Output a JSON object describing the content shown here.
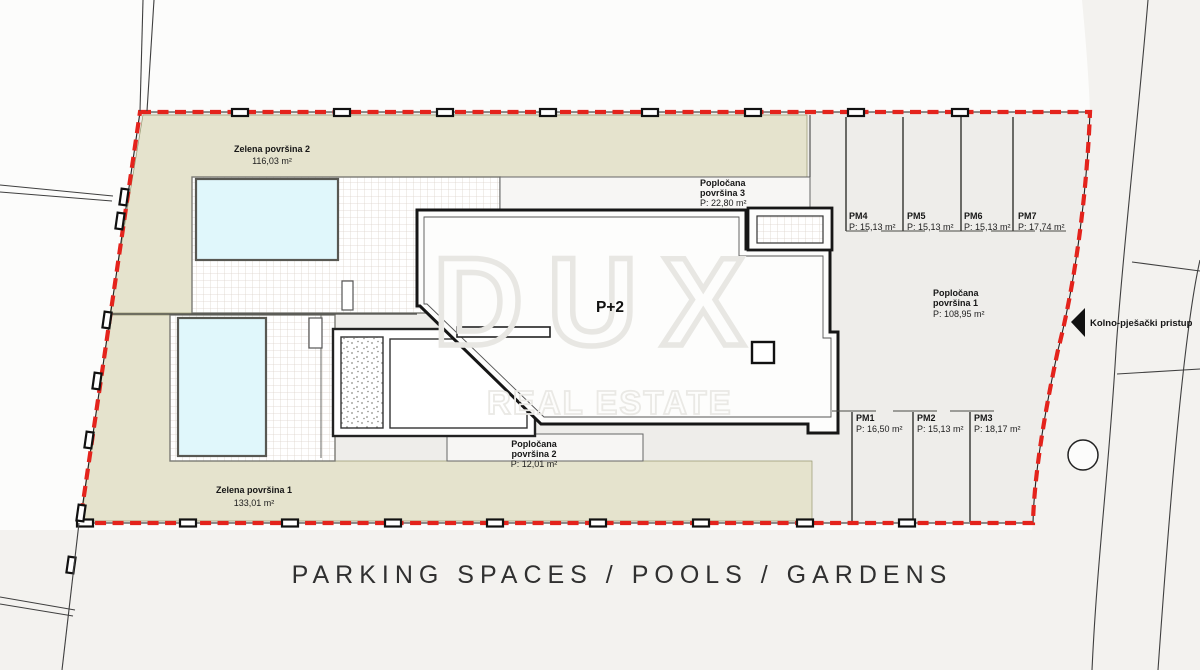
{
  "plan_title": "PARKING SPACES / POOLS / GARDENS",
  "watermark": {
    "brand": "DUX",
    "tagline": "REAL ESTATE"
  },
  "building": {
    "floors_label": "P+2"
  },
  "access_road": {
    "label": "Kolno-pješački pristup"
  },
  "green_areas": [
    {
      "name": "Zelena površina 2",
      "area": "116,03 m²"
    },
    {
      "name": "Zelena površina 1",
      "area": "133,01 m²"
    }
  ],
  "paved_areas": [
    {
      "name_line1": "Popločana",
      "name_line2": "površina 1",
      "area": "P: 108,95 m²"
    },
    {
      "name_line1": "Popločana",
      "name_line2": "površina 2",
      "area": "P: 12,01 m²"
    },
    {
      "name_line1": "Popločana",
      "name_line2": "površina 3",
      "area": "P: 22,80 m²"
    }
  ],
  "parking_spaces": [
    {
      "id": "PM1",
      "area": "P: 16,50 m²"
    },
    {
      "id": "PM2",
      "area": "P: 15,13 m²"
    },
    {
      "id": "PM3",
      "area": "P: 18,17 m²"
    },
    {
      "id": "PM4",
      "area": "P: 15,13 m²"
    },
    {
      "id": "PM5",
      "area": "P: 15,13 m²"
    },
    {
      "id": "PM6",
      "area": "P: 15,13 m²"
    },
    {
      "id": "PM7",
      "area": "P: 17,74 m²"
    }
  ],
  "colors": {
    "boundary_red": "#e4231c",
    "garden_green": "#e5e3cd",
    "pool_blue": "#e0f7fb",
    "paved_gray": "#eeedea"
  }
}
